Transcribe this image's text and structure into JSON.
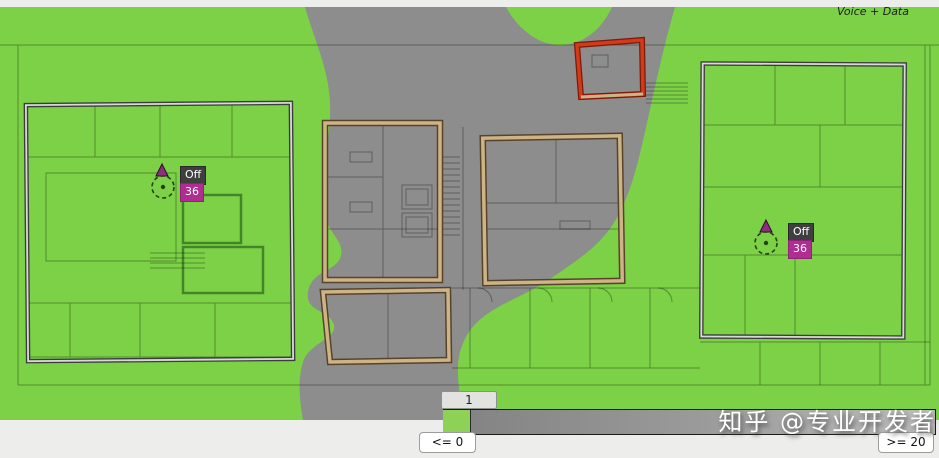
{
  "app": {
    "name": "wifi-heatmap-viewer"
  },
  "colors": {
    "coverage_green": "#7cd147",
    "no_coverage_gray": "#8d8d8d",
    "zone_tan": "#cdb387",
    "zone_red": "#d23a1a",
    "zone_outline_dark": "#3c3c3c",
    "badge_status_bg": "#3f3f3f",
    "badge_value_bg": "#b02d92",
    "legend_green": "#8ed157"
  },
  "access_points": [
    {
      "id": "ap-left",
      "status": "Off",
      "value": "36"
    },
    {
      "id": "ap-right",
      "status": "Off",
      "value": "36"
    }
  ],
  "legend": {
    "handle_value": "1",
    "min_label": "<= 0",
    "max_label": ">= 20",
    "bar_label": "Voice + Data"
  },
  "watermark": {
    "text": "知乎 @专业开发者"
  }
}
